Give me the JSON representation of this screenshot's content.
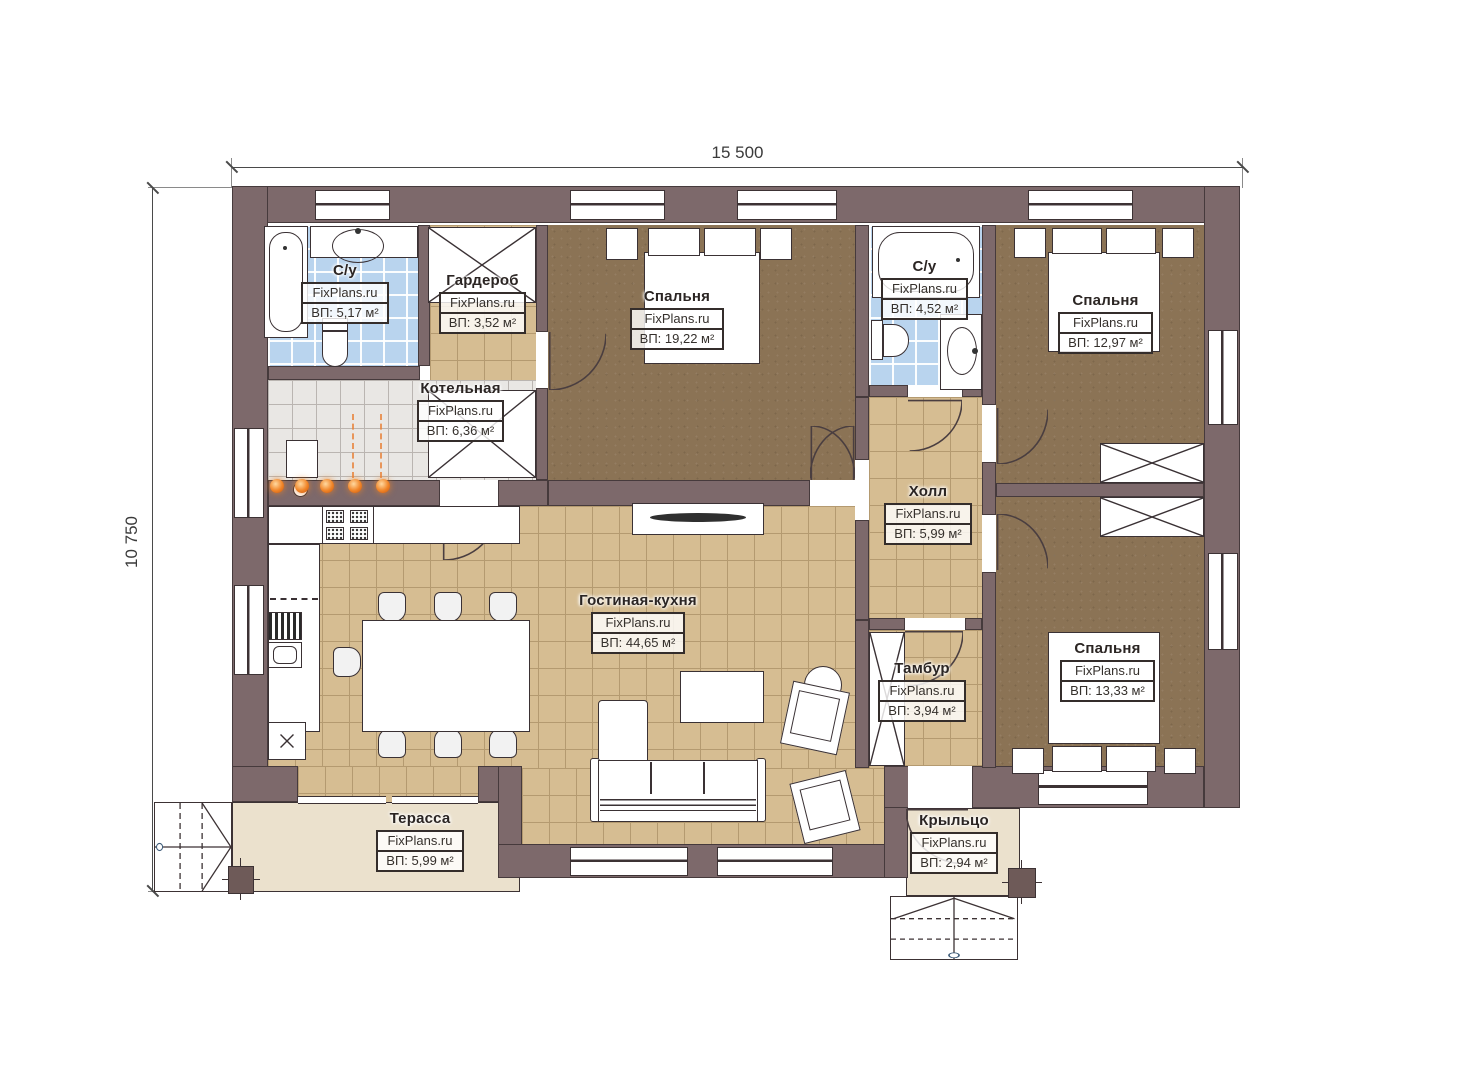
{
  "dimensions": {
    "width": "15 500",
    "height": "10 750"
  },
  "watermark": "FixPlans.ru",
  "rooms": [
    {
      "name": "С/у",
      "area": "ВП: 5,17 м²"
    },
    {
      "name": "Гардероб",
      "area": "ВП: 3,52 м²"
    },
    {
      "name": "Спальня",
      "area": "ВП: 19,22 м²"
    },
    {
      "name": "С/у",
      "area": "ВП: 4,52 м²"
    },
    {
      "name": "Спальня",
      "area": "ВП: 12,97 м²"
    },
    {
      "name": "Котельная",
      "area": "ВП: 6,36 м²"
    },
    {
      "name": "Холл",
      "area": "ВП: 5,99 м²"
    },
    {
      "name": "Гостиная-кухня",
      "area": "ВП: 44,65 м²"
    },
    {
      "name": "Тамбур",
      "area": "ВП: 3,94 м²"
    },
    {
      "name": "Спальня",
      "area": "ВП: 13,33 м²"
    },
    {
      "name": "Терасса",
      "area": "ВП: 5,99 м²"
    },
    {
      "name": "Крыльцо",
      "area": "ВП: 2,94 м²"
    }
  ],
  "colors": {
    "wall": "#7d696b",
    "wall_outline": "#463a3c",
    "floor_tile_tan": "#d6bd92",
    "floor_brown": "#8b7355",
    "tile_blue": "#b9d4ee",
    "tile_gray": "#e9e7e4",
    "outdoor_beige": "#ebe1cd",
    "lamp_orange": "#f08427",
    "line_dark": "#3c3234"
  }
}
